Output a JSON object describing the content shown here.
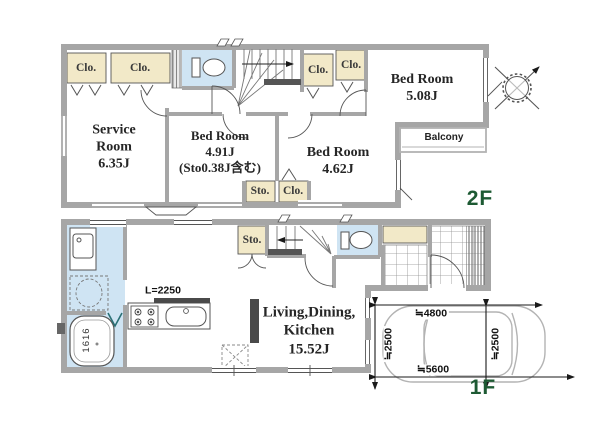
{
  "palette": {
    "closet_fill": "#f2e9c8",
    "wet_area_fill": "#cfe4f3",
    "wall_gray": "#a6a6a6",
    "floor_label_green": "#1d5a33",
    "counter_dark": "#4a4a4a"
  },
  "floor2": {
    "floor_label": "2F",
    "service_room_label": "Service\nRoom\n6.35J",
    "bedroom_a_label": "Bed Room\n4.91J\n(Sto0.38J含む)",
    "bedroom_b_label": "Bed Room\n4.62J",
    "bedroom_c_label": "Bed Room\n5.08J",
    "balcony_label": "Balcony",
    "closet_top_left_1": "Clo.",
    "closet_top_left_2": "Clo.",
    "closet_top_right_1": "Clo.",
    "closet_top_right_2": "Clo.",
    "storage_bottom": "Sto.",
    "closet_bottom": "Clo."
  },
  "floor1": {
    "floor_label": "1F",
    "ldk_label": "Living,Dining,\nKitchen\n15.52J",
    "storage_label": "Sto.",
    "bath_unit_size": "1616",
    "kitchen_counter_length": "L=2250",
    "parking": {
      "dim_width_upper": "≒4800",
      "dim_width_lower": "≒5600",
      "dim_depth_left": "≒2500",
      "dim_depth_right": "≒2500"
    }
  }
}
